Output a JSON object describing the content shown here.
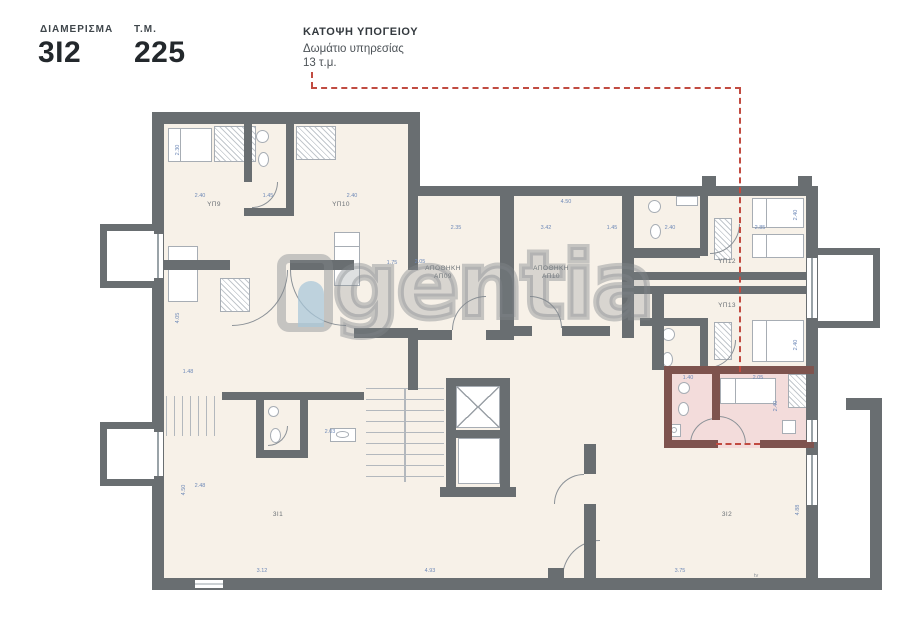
{
  "header": {
    "apartment_label": "ΔΙΑΜΕΡΙΣΜΑ",
    "apartment_value": "3Ι2",
    "area_label": "Τ.Μ.",
    "area_value": "225",
    "plan_title": "ΚΑΤΟΨΗ ΥΠΟΓΕΙΟΥ",
    "callout_line1": "Δωμάτιο υπηρεσίας",
    "callout_line2": "13 τ.μ."
  },
  "watermark": {
    "text": "gentia",
    "logo": "agentia-logo"
  },
  "colors": {
    "wall": "#696e71",
    "floor": "#f7f1e8",
    "highlight_fill": "#f3dcdb",
    "highlight_wall": "#7e534e",
    "accent_red": "#c14b41",
    "dimension_blue": "#6f8ab8",
    "label_gray": "#6b7176"
  },
  "floorplan": {
    "floors": [
      [
        164,
        124,
        250,
        454
      ],
      [
        408,
        192,
        398,
        386
      ]
    ],
    "highlight": [
      664,
      366,
      150,
      82
    ],
    "walls": [
      [
        152,
        112,
        268,
        12
      ],
      [
        152,
        112,
        12,
        478
      ],
      [
        152,
        578,
        728,
        12
      ],
      [
        408,
        112,
        12,
        84
      ],
      [
        408,
        186,
        410,
        10
      ],
      [
        806,
        186,
        12,
        190
      ],
      [
        806,
        366,
        12,
        84
      ],
      [
        806,
        444,
        12,
        146
      ],
      [
        846,
        398,
        36,
        12
      ],
      [
        870,
        398,
        12,
        192
      ],
      [
        244,
        124,
        8,
        58
      ],
      [
        286,
        124,
        8,
        92
      ],
      [
        244,
        208,
        50,
        8
      ],
      [
        164,
        260,
        66,
        10
      ],
      [
        290,
        260,
        64,
        10
      ],
      [
        354,
        328,
        64,
        10
      ],
      [
        408,
        196,
        10,
        74
      ],
      [
        408,
        328,
        10,
        62
      ],
      [
        500,
        192,
        14,
        148
      ],
      [
        418,
        330,
        34,
        10
      ],
      [
        486,
        330,
        16,
        10
      ],
      [
        514,
        326,
        18,
        10
      ],
      [
        562,
        326,
        48,
        10
      ],
      [
        622,
        192,
        12,
        146
      ],
      [
        630,
        272,
        176,
        8
      ],
      [
        630,
        286,
        176,
        8
      ],
      [
        634,
        248,
        66,
        10
      ],
      [
        700,
        192,
        8,
        64
      ],
      [
        652,
        286,
        12,
        84
      ],
      [
        640,
        318,
        60,
        8
      ],
      [
        700,
        318,
        8,
        56
      ],
      [
        446,
        378,
        10,
        117
      ],
      [
        500,
        378,
        10,
        117
      ],
      [
        446,
        378,
        64,
        8
      ],
      [
        448,
        430,
        60,
        8
      ],
      [
        440,
        487,
        76,
        10
      ],
      [
        584,
        444,
        12,
        30
      ],
      [
        584,
        504,
        12,
        74
      ],
      [
        222,
        392,
        142,
        8
      ],
      [
        256,
        400,
        8,
        56
      ],
      [
        300,
        400,
        8,
        56
      ],
      [
        256,
        450,
        52,
        8
      ],
      [
        702,
        176,
        14,
        12
      ],
      [
        798,
        176,
        14,
        12
      ],
      [
        548,
        568,
        16,
        12
      ]
    ],
    "highlight_walls": [
      [
        664,
        366,
        150,
        8
      ],
      [
        664,
        366,
        8,
        80
      ],
      [
        664,
        440,
        54,
        8
      ],
      [
        760,
        440,
        54,
        8
      ],
      [
        712,
        374,
        8,
        46
      ]
    ],
    "lightwells": [
      [
        100,
        224,
        54,
        64,
        "r"
      ],
      [
        100,
        422,
        54,
        64,
        "r"
      ],
      [
        818,
        248,
        62,
        80,
        "l"
      ]
    ],
    "windows": [
      [
        153,
        234,
        10,
        44,
        "v"
      ],
      [
        153,
        432,
        10,
        44,
        "v"
      ],
      [
        807,
        258,
        10,
        60,
        "v"
      ],
      [
        807,
        420,
        10,
        22,
        "v"
      ],
      [
        807,
        455,
        10,
        50,
        "v"
      ],
      [
        195,
        580,
        28,
        8,
        "h"
      ]
    ],
    "fixtures": [
      [
        "bed",
        168,
        128,
        44,
        34
      ],
      [
        "closet",
        214,
        126,
        42,
        36
      ],
      [
        "closet",
        296,
        126,
        40,
        34
      ],
      [
        "bed",
        334,
        232,
        26,
        54
      ],
      [
        "bed",
        168,
        246,
        30,
        56
      ],
      [
        "closet",
        220,
        278,
        30,
        34
      ],
      [
        "sink",
        256,
        130,
        13,
        13
      ],
      [
        "wc",
        258,
        152,
        11,
        15
      ],
      [
        "bed",
        752,
        198,
        52,
        30
      ],
      [
        "bed",
        752,
        234,
        52,
        24
      ],
      [
        "closet",
        714,
        218,
        18,
        42
      ],
      [
        "sink",
        648,
        200,
        13,
        13
      ],
      [
        "wc",
        650,
        224,
        11,
        15
      ],
      [
        "rect",
        676,
        196,
        22,
        10
      ],
      [
        "bed",
        752,
        320,
        52,
        42
      ],
      [
        "closet",
        714,
        322,
        18,
        38
      ],
      [
        "sink",
        662,
        328,
        13,
        13
      ],
      [
        "wc",
        662,
        352,
        11,
        15
      ],
      [
        "bed",
        720,
        378,
        56,
        26
      ],
      [
        "closet",
        788,
        374,
        22,
        34
      ],
      [
        "rect",
        782,
        420,
        14,
        14
      ],
      [
        "sink",
        678,
        382,
        12,
        12
      ],
      [
        "wc",
        678,
        402,
        11,
        14
      ],
      [
        "shower",
        668,
        424,
        13,
        13
      ],
      [
        "sink",
        268,
        406,
        11,
        11
      ],
      [
        "wc",
        270,
        428,
        11,
        15
      ],
      [
        "ksink",
        330,
        428,
        26,
        14
      ],
      [
        "stairsH",
        366,
        388,
        78,
        94
      ],
      [
        "vline",
        404,
        388,
        2,
        94
      ],
      [
        "stairsV",
        166,
        396,
        52,
        40
      ],
      [
        "rect",
        456,
        386,
        44,
        42
      ],
      [
        "xbox",
        456,
        386,
        44,
        42
      ],
      [
        "rect",
        458,
        438,
        42,
        46
      ]
    ],
    "doors": [
      [
        232,
        270,
        56,
        "br"
      ],
      [
        290,
        270,
        56,
        "bl"
      ],
      [
        452,
        296,
        34,
        "tl"
      ],
      [
        530,
        296,
        32,
        "tr"
      ],
      [
        252,
        182,
        26,
        "br"
      ],
      [
        710,
        224,
        30,
        "br"
      ],
      [
        708,
        340,
        28,
        "br"
      ],
      [
        690,
        418,
        26,
        "tl"
      ],
      [
        718,
        416,
        28,
        "tr"
      ],
      [
        562,
        540,
        38,
        "tl"
      ],
      [
        554,
        474,
        30,
        "tl"
      ],
      [
        268,
        426,
        20,
        "br"
      ]
    ],
    "room_labels": [
      [
        "ΥΠ9",
        214,
        205
      ],
      [
        "ΥΠ10",
        341,
        205
      ],
      [
        "ΑΠΟΘΗΚΗ\nΑΠ09",
        443,
        273
      ],
      [
        "ΑΠΟΘΗΚΗ\nΑΠ10",
        551,
        273
      ],
      [
        "ΥΠ12",
        727,
        262
      ],
      [
        "ΥΠ13",
        727,
        306
      ],
      [
        "3Ι1",
        278,
        515
      ],
      [
        "3Ι2",
        727,
        515
      ]
    ],
    "dimensions": [
      [
        "2.40",
        200,
        196,
        0
      ],
      [
        "1.45",
        268,
        196,
        0
      ],
      [
        "2.40",
        352,
        196,
        0
      ],
      [
        "2.35",
        456,
        228,
        0
      ],
      [
        "3.42",
        546,
        228,
        0
      ],
      [
        "4.50",
        566,
        202,
        0
      ],
      [
        "1.45",
        612,
        228,
        0
      ],
      [
        "2.40",
        670,
        228,
        0
      ],
      [
        "2.85",
        760,
        228,
        0
      ],
      [
        "1.75",
        392,
        263,
        0
      ],
      [
        "1.40",
        688,
        378,
        0
      ],
      [
        "2.05",
        758,
        378,
        0
      ],
      [
        "2.40",
        776,
        406,
        1
      ],
      [
        "2.40",
        796,
        215,
        1
      ],
      [
        "2.40",
        796,
        345,
        1
      ],
      [
        "2.30",
        178,
        150,
        1
      ],
      [
        "4.05",
        178,
        318,
        1
      ],
      [
        "4.50",
        184,
        490,
        1
      ],
      [
        "3.12",
        262,
        571,
        0
      ],
      [
        "2.03",
        330,
        432,
        0
      ],
      [
        "4.93",
        430,
        571,
        0
      ],
      [
        "3.75",
        680,
        571,
        0
      ],
      [
        "1.48",
        188,
        372,
        0
      ],
      [
        "2.48",
        200,
        486,
        0
      ],
      [
        "4.88",
        798,
        510,
        1
      ],
      [
        "2.05",
        420,
        262,
        0
      ]
    ],
    "leader_segments": [
      [
        311,
        72,
        2,
        16
      ],
      [
        311,
        87,
        430,
        2
      ],
      [
        739,
        88,
        2,
        284
      ]
    ],
    "highlight_door_dash": [
      716,
      443,
      44,
      2
    ],
    "misc_texts": [
      [
        "tv",
        754,
        573
      ]
    ]
  }
}
